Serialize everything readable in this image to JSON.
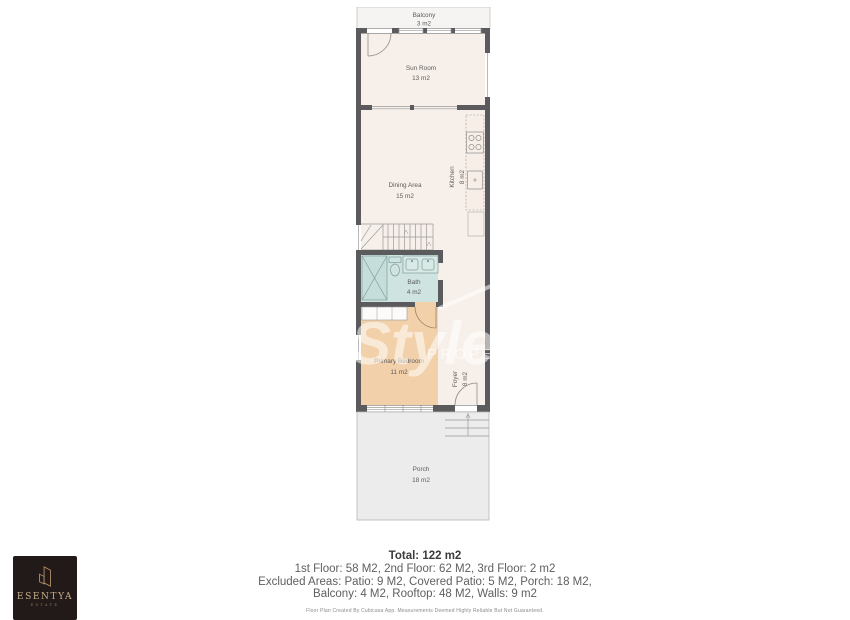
{
  "plan": {
    "rooms": {
      "balcony": {
        "name": "Balcony",
        "area": "3 m2"
      },
      "sun_room": {
        "name": "Sun Room",
        "area": "13 m2"
      },
      "dining": {
        "name": "Dining Area",
        "area": "15 m2"
      },
      "kitchen": {
        "name": "Kitchen",
        "area": "8 m2"
      },
      "bath": {
        "name": "Bath",
        "area": "4 m2"
      },
      "bedroom": {
        "name": "Primary Bedroom",
        "area": "11 m2"
      },
      "foyer": {
        "name": "Foyer",
        "area": "8 m2"
      },
      "porch": {
        "name": "Porch",
        "area": "18 m2"
      }
    },
    "watermark": {
      "script": "Style",
      "caps": "PROPERT"
    }
  },
  "summary": {
    "total": "Total: 122 m2",
    "floors": "1st Floor: 58 M2, 2nd Floor: 62 M2, 3rd Floor: 2 m2",
    "excluded_1": "Excluded Areas: Patio: 9 M2, Covered Patio: 5 M2, Porch: 18 M2,",
    "excluded_2": "Balcony: 4 M2, Rooftop: 48 M2, Walls: 9 m2",
    "disclaimer": "Floor Plan Created By Cubicasa App. Measurements Deemed Highly Reliable But Not Guaranteed."
  },
  "logo": {
    "brand": "ESENTYA",
    "sub": "ESTATE"
  },
  "colors": {
    "wall": "#5b5b5d",
    "interior": "#f7efe9",
    "bedroom": "#f2d0a9",
    "bath": "#cfe3e0",
    "porch": "#ececec",
    "balcony": "#f5f4f2",
    "logo_bg": "#221919",
    "logo_gold": "#cbb08c"
  }
}
